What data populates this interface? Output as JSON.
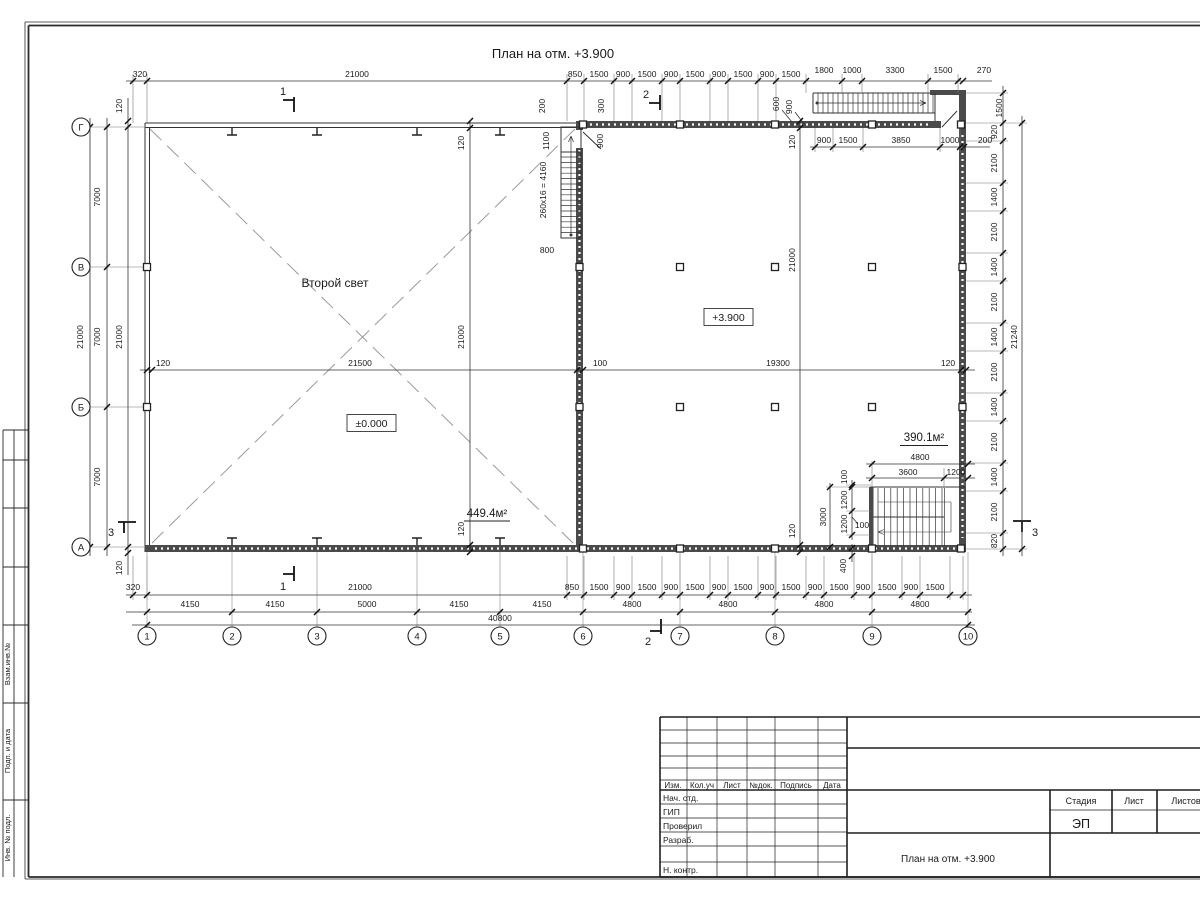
{
  "title": "План на отм. +3.900",
  "plan": {
    "room_label": "Второй свет",
    "level_left": "±0.000",
    "level_right": "+3.900",
    "area_left": "449.4м²",
    "area_right": "390.1м²",
    "stair_note": "260x16 = 4160"
  },
  "axes": {
    "bottom": [
      {
        "label": "1",
        "x": 147
      },
      {
        "label": "2",
        "x": 232
      },
      {
        "label": "3",
        "x": 317
      },
      {
        "label": "4",
        "x": 417
      },
      {
        "label": "5",
        "x": 500
      },
      {
        "label": "6",
        "x": 583
      },
      {
        "label": "7",
        "x": 680
      },
      {
        "label": "8",
        "x": 775
      },
      {
        "label": "9",
        "x": 872
      },
      {
        "label": "10",
        "x": 968
      }
    ],
    "left": [
      {
        "label": "Г",
        "y": 127
      },
      {
        "label": "В",
        "y": 267
      },
      {
        "label": "Б",
        "y": 407
      },
      {
        "label": "А",
        "y": 547
      }
    ]
  },
  "sections": [
    {
      "label": "1",
      "x": 283,
      "y": 95
    },
    {
      "label": "1",
      "x": 283,
      "y": 590
    },
    {
      "label": "2",
      "x": 646,
      "y": 98
    },
    {
      "label": "2",
      "x": 648,
      "y": 645
    },
    {
      "label": "3",
      "x": 111,
      "y": 536
    },
    {
      "label": "3",
      "x": 1035,
      "y": 536
    }
  ],
  "dims": [
    {
      "t": "320",
      "x": 140,
      "y": 77
    },
    {
      "t": "21000",
      "x": 357,
      "y": 77
    },
    {
      "t": "850",
      "x": 575,
      "y": 77
    },
    {
      "t": "1500",
      "x": 599,
      "y": 77
    },
    {
      "t": "900",
      "x": 623,
      "y": 77
    },
    {
      "t": "1500",
      "x": 647,
      "y": 77
    },
    {
      "t": "900",
      "x": 671,
      "y": 77
    },
    {
      "t": "1500",
      "x": 695,
      "y": 77
    },
    {
      "t": "900",
      "x": 719,
      "y": 77
    },
    {
      "t": "1500",
      "x": 743,
      "y": 77
    },
    {
      "t": "900",
      "x": 767,
      "y": 77
    },
    {
      "t": "1500",
      "x": 791,
      "y": 77
    },
    {
      "t": "1800",
      "x": 824,
      "y": 73
    },
    {
      "t": "1000",
      "x": 852,
      "y": 73
    },
    {
      "t": "3300",
      "x": 895,
      "y": 73
    },
    {
      "t": "1500",
      "x": 943,
      "y": 73
    },
    {
      "t": "270",
      "x": 984,
      "y": 73
    },
    {
      "t": "900",
      "x": 824,
      "y": 143
    },
    {
      "t": "1500",
      "x": 848,
      "y": 143
    },
    {
      "t": "3850",
      "x": 901,
      "y": 143
    },
    {
      "t": "1000",
      "x": 950,
      "y": 143
    },
    {
      "t": "200",
      "x": 985,
      "y": 143
    },
    {
      "t": "200",
      "x": 545,
      "y": 106,
      "r": 1
    },
    {
      "t": "300",
      "x": 604,
      "y": 106,
      "r": 1
    },
    {
      "t": "1100",
      "x": 549,
      "y": 141,
      "r": 1
    },
    {
      "t": "900",
      "x": 603,
      "y": 141,
      "r": 1
    },
    {
      "t": "600",
      "x": 779,
      "y": 104,
      "r": 1
    },
    {
      "t": "900",
      "x": 792,
      "y": 107,
      "r": 1
    },
    {
      "t": "1500",
      "x": 1002,
      "y": 108,
      "r": 1
    },
    {
      "t": "920",
      "x": 997,
      "y": 132,
      "r": 1
    },
    {
      "t": "2100",
      "x": 997,
      "y": 163,
      "r": 1
    },
    {
      "t": "1400",
      "x": 997,
      "y": 197,
      "r": 1
    },
    {
      "t": "2100",
      "x": 997,
      "y": 232,
      "r": 1
    },
    {
      "t": "1400",
      "x": 997,
      "y": 267,
      "r": 1
    },
    {
      "t": "2100",
      "x": 997,
      "y": 302,
      "r": 1
    },
    {
      "t": "1400",
      "x": 997,
      "y": 337,
      "r": 1
    },
    {
      "t": "2100",
      "x": 997,
      "y": 372,
      "r": 1
    },
    {
      "t": "1400",
      "x": 997,
      "y": 407,
      "r": 1
    },
    {
      "t": "2100",
      "x": 997,
      "y": 442,
      "r": 1
    },
    {
      "t": "1400",
      "x": 997,
      "y": 477,
      "r": 1
    },
    {
      "t": "2100",
      "x": 997,
      "y": 512,
      "r": 1
    },
    {
      "t": "820",
      "x": 997,
      "y": 541,
      "r": 1
    },
    {
      "t": "21240",
      "x": 1017,
      "y": 337,
      "r": 1
    },
    {
      "t": "320",
      "x": 133,
      "y": 590
    },
    {
      "t": "21000",
      "x": 360,
      "y": 590
    },
    {
      "t": "850",
      "x": 572,
      "y": 590
    },
    {
      "t": "1500",
      "x": 599,
      "y": 590
    },
    {
      "t": "900",
      "x": 623,
      "y": 590
    },
    {
      "t": "1500",
      "x": 647,
      "y": 590
    },
    {
      "t": "900",
      "x": 671,
      "y": 590
    },
    {
      "t": "1500",
      "x": 695,
      "y": 590
    },
    {
      "t": "900",
      "x": 719,
      "y": 590
    },
    {
      "t": "1500",
      "x": 743,
      "y": 590
    },
    {
      "t": "900",
      "x": 767,
      "y": 590
    },
    {
      "t": "1500",
      "x": 791,
      "y": 590
    },
    {
      "t": "900",
      "x": 815,
      "y": 590
    },
    {
      "t": "1500",
      "x": 839,
      "y": 590
    },
    {
      "t": "900",
      "x": 863,
      "y": 590
    },
    {
      "t": "1500",
      "x": 887,
      "y": 590
    },
    {
      "t": "900",
      "x": 911,
      "y": 590
    },
    {
      "t": "1500",
      "x": 935,
      "y": 590
    },
    {
      "t": "4150",
      "x": 190,
      "y": 607
    },
    {
      "t": "4150",
      "x": 275,
      "y": 607
    },
    {
      "t": "5000",
      "x": 367,
      "y": 607
    },
    {
      "t": "4150",
      "x": 459,
      "y": 607
    },
    {
      "t": "4150",
      "x": 542,
      "y": 607
    },
    {
      "t": "4800",
      "x": 632,
      "y": 607
    },
    {
      "t": "4800",
      "x": 728,
      "y": 607
    },
    {
      "t": "4800",
      "x": 824,
      "y": 607
    },
    {
      "t": "4800",
      "x": 920,
      "y": 607
    },
    {
      "t": "40800",
      "x": 500,
      "y": 621
    },
    {
      "t": "21000",
      "x": 83,
      "y": 337,
      "r": 1
    },
    {
      "t": "7000",
      "x": 100,
      "y": 197,
      "r": 1
    },
    {
      "t": "7000",
      "x": 100,
      "y": 337,
      "r": 1
    },
    {
      "t": "7000",
      "x": 100,
      "y": 477,
      "r": 1
    },
    {
      "t": "120",
      "x": 122,
      "y": 106,
      "r": 1
    },
    {
      "t": "21000",
      "x": 122,
      "y": 337,
      "r": 1
    },
    {
      "t": "120",
      "x": 122,
      "y": 568,
      "r": 1
    },
    {
      "t": "120",
      "x": 163,
      "y": 366
    },
    {
      "t": "21500",
      "x": 360,
      "y": 366
    },
    {
      "t": "100",
      "x": 600,
      "y": 366
    },
    {
      "t": "19300",
      "x": 778,
      "y": 366
    },
    {
      "t": "120",
      "x": 948,
      "y": 366
    },
    {
      "t": "120",
      "x": 464,
      "y": 143,
      "r": 1
    },
    {
      "t": "21000",
      "x": 464,
      "y": 337,
      "r": 1
    },
    {
      "t": "120",
      "x": 464,
      "y": 529,
      "r": 1
    },
    {
      "t": "120",
      "x": 795,
      "y": 142,
      "r": 1
    },
    {
      "t": "21000",
      "x": 795,
      "y": 260,
      "r": 1
    },
    {
      "t": "120",
      "x": 795,
      "y": 531,
      "r": 1
    },
    {
      "t": "4800",
      "x": 920,
      "y": 460
    },
    {
      "t": "3600",
      "x": 908,
      "y": 475
    },
    {
      "t": "1200",
      "x": 956,
      "y": 475
    },
    {
      "t": "100",
      "x": 847,
      "y": 477,
      "r": 1
    },
    {
      "t": "1200",
      "x": 847,
      "y": 500,
      "r": 1
    },
    {
      "t": "1200",
      "x": 847,
      "y": 524,
      "r": 1
    },
    {
      "t": "3000",
      "x": 826,
      "y": 517,
      "r": 1
    },
    {
      "t": "400",
      "x": 846,
      "y": 566,
      "r": 1
    },
    {
      "t": "100",
      "x": 862,
      "y": 528
    },
    {
      "t": "800",
      "x": 547,
      "y": 253
    }
  ],
  "title_block": {
    "rev_headers": [
      "Изм.",
      "Кол.уч",
      "Лист",
      "№док.",
      "Подпись",
      "Дата"
    ],
    "roles": [
      "Нач. отд.",
      "ГИП",
      "Проверил",
      "Разраб.",
      "Н. контр."
    ],
    "stage_header": "Стадия",
    "sheet_header": "Лист",
    "sheets_header": "Листов",
    "stage_value": "ЭП",
    "doc_title": "План на отм. +3.900"
  },
  "side_stamp": {
    "labels": [
      "Взам.инв.№",
      "Подп. и дата",
      "Инв. № подл."
    ]
  }
}
